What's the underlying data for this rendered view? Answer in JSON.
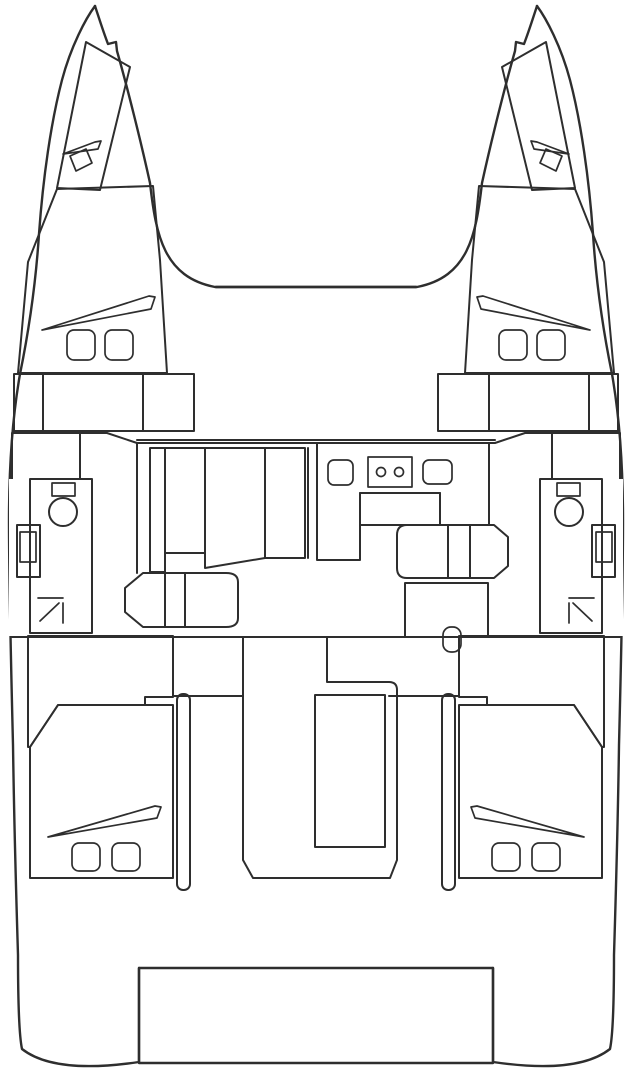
{
  "diagram": {
    "type": "catamaran-deck-plan",
    "view": "top-down-bow-up",
    "hull_count": "2"
  },
  "palette": {
    "background": "#ffffff",
    "outline": "#2e2e2e",
    "deck_white": "#ffffff",
    "forepeak_gray_blue": "#bdd0d5",
    "cabin_teal": "#7fb1c1",
    "berth_light_blue": "#a3d9e9",
    "saloon_yellow": "#f8d68e",
    "bathroom_green": "#b7cd8d",
    "cockpit_tan": "#c1ae97",
    "fixture_black": "#1f1f1f"
  },
  "areas": [
    {
      "id": "forepeak",
      "color_key": "forepeak_gray_blue",
      "count_visible": 2
    },
    {
      "id": "forward-cabin",
      "color_key": "cabin_teal",
      "count_visible": 2
    },
    {
      "id": "berth-step",
      "color_key": "berth_light_blue",
      "count_visible": 2
    },
    {
      "id": "bathroom-head",
      "color_key": "bathroom_green",
      "count_visible": 2
    },
    {
      "id": "saloon-galley-deck",
      "color_key": "saloon_yellow",
      "count_visible": 1
    },
    {
      "id": "aft-cabin",
      "color_key": "cabin_teal",
      "count_visible": 2
    },
    {
      "id": "cockpit-passage",
      "color_key": "cockpit_tan",
      "count_visible": 1
    },
    {
      "id": "swim-platform",
      "color_key": "deck_white",
      "count_visible": 1
    }
  ]
}
